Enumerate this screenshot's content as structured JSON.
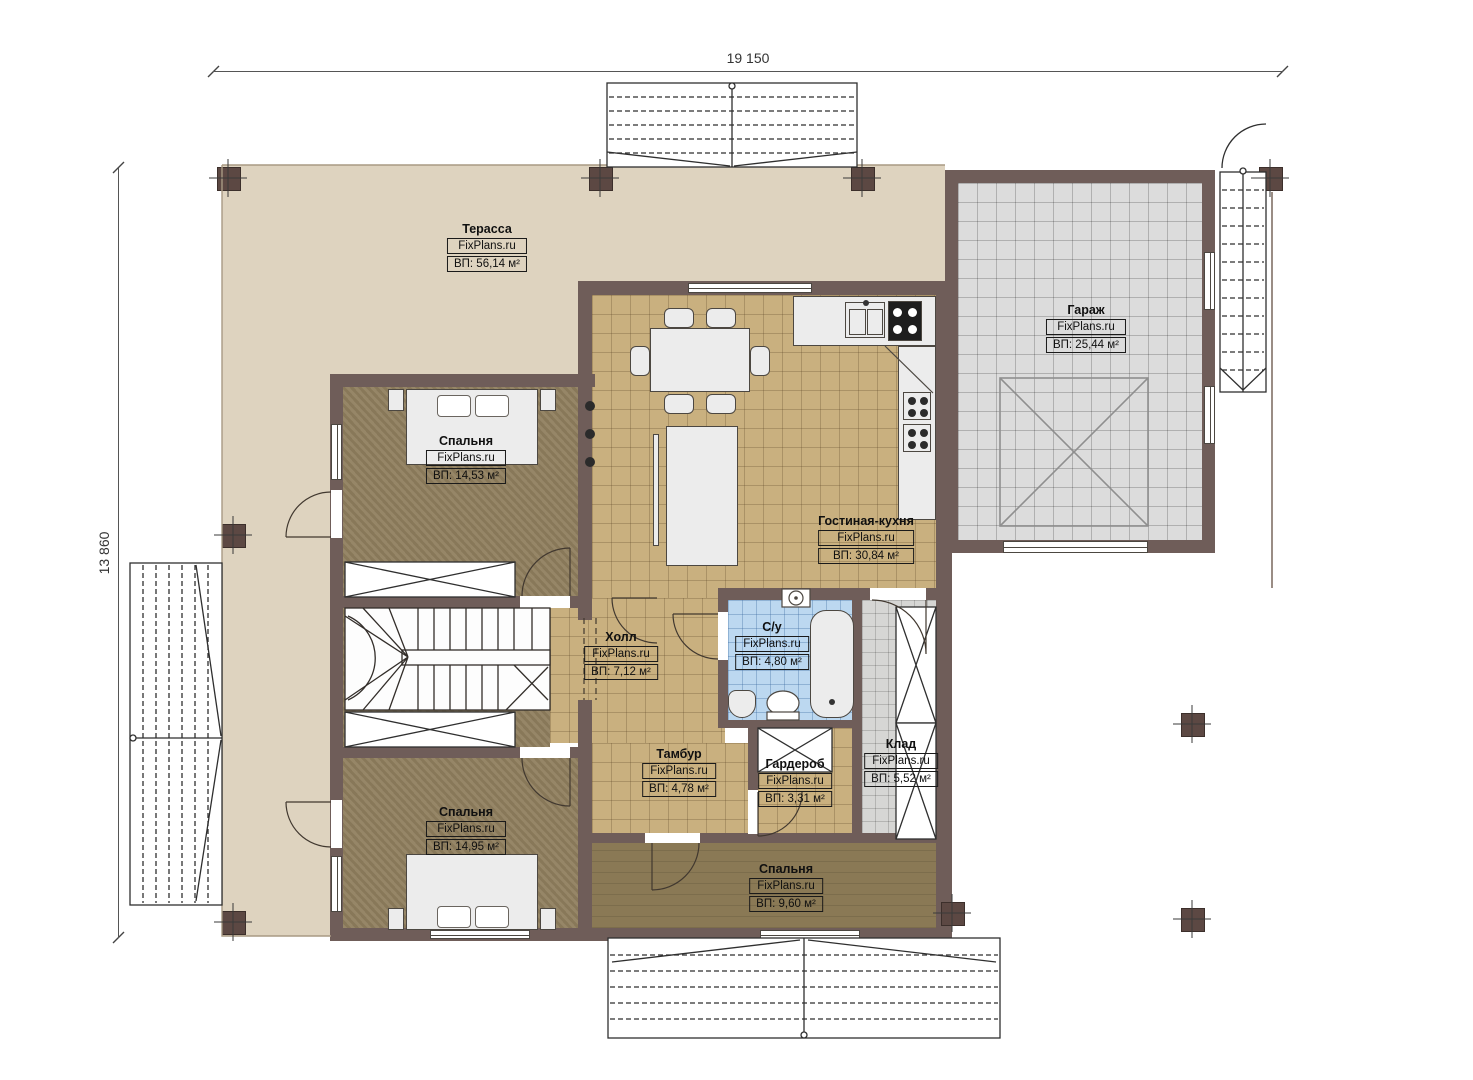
{
  "plan": {
    "type": "floor-plan",
    "brand": "FixPlans.ru",
    "dimensions": {
      "width_label": "19 150",
      "height_label": "13 860"
    },
    "colors": {
      "wall": "#6f5d59",
      "terrace_floor": "#ded3bf",
      "kitchen_tile": "#c9b07f",
      "bathroom_tile": "#bcd8f0",
      "garage_tile": "#dcdcdc",
      "storage_tile": "#d6d6d4",
      "bedroom_floor": "#8f7e5e",
      "wood_floor": "#8a7955"
    }
  },
  "rooms": [
    {
      "name": "Терасса",
      "brand": "FixPlans.ru",
      "area": "ВП: 56,14 м²"
    },
    {
      "name": "Гараж",
      "brand": "FixPlans.ru",
      "area": "ВП: 25,44 м²"
    },
    {
      "name": "Спальня",
      "brand": "FixPlans.ru",
      "area": "ВП: 14,53 м²"
    },
    {
      "name": "Гостиная-кухня",
      "brand": "FixPlans.ru",
      "area": "ВП: 30,84 м²"
    },
    {
      "name": "Холл",
      "brand": "FixPlans.ru",
      "area": "ВП: 7,12 м²"
    },
    {
      "name": "С/у",
      "brand": "FixPlans.ru",
      "area": "ВП: 4,80 м²"
    },
    {
      "name": "Тамбур",
      "brand": "FixPlans.ru",
      "area": "ВП: 4,78 м²"
    },
    {
      "name": "Гардероб",
      "brand": "FixPlans.ru",
      "area": "ВП: 3,31 м²"
    },
    {
      "name": "Клад",
      "brand": "FixPlans.ru",
      "area": "ВП: 5,52 м²"
    },
    {
      "name": "Спальня",
      "brand": "FixPlans.ru",
      "area": "ВП: 14,95 м²"
    },
    {
      "name": "Спальня",
      "brand": "FixPlans.ru",
      "area": "ВП: 9,60 м²"
    }
  ]
}
